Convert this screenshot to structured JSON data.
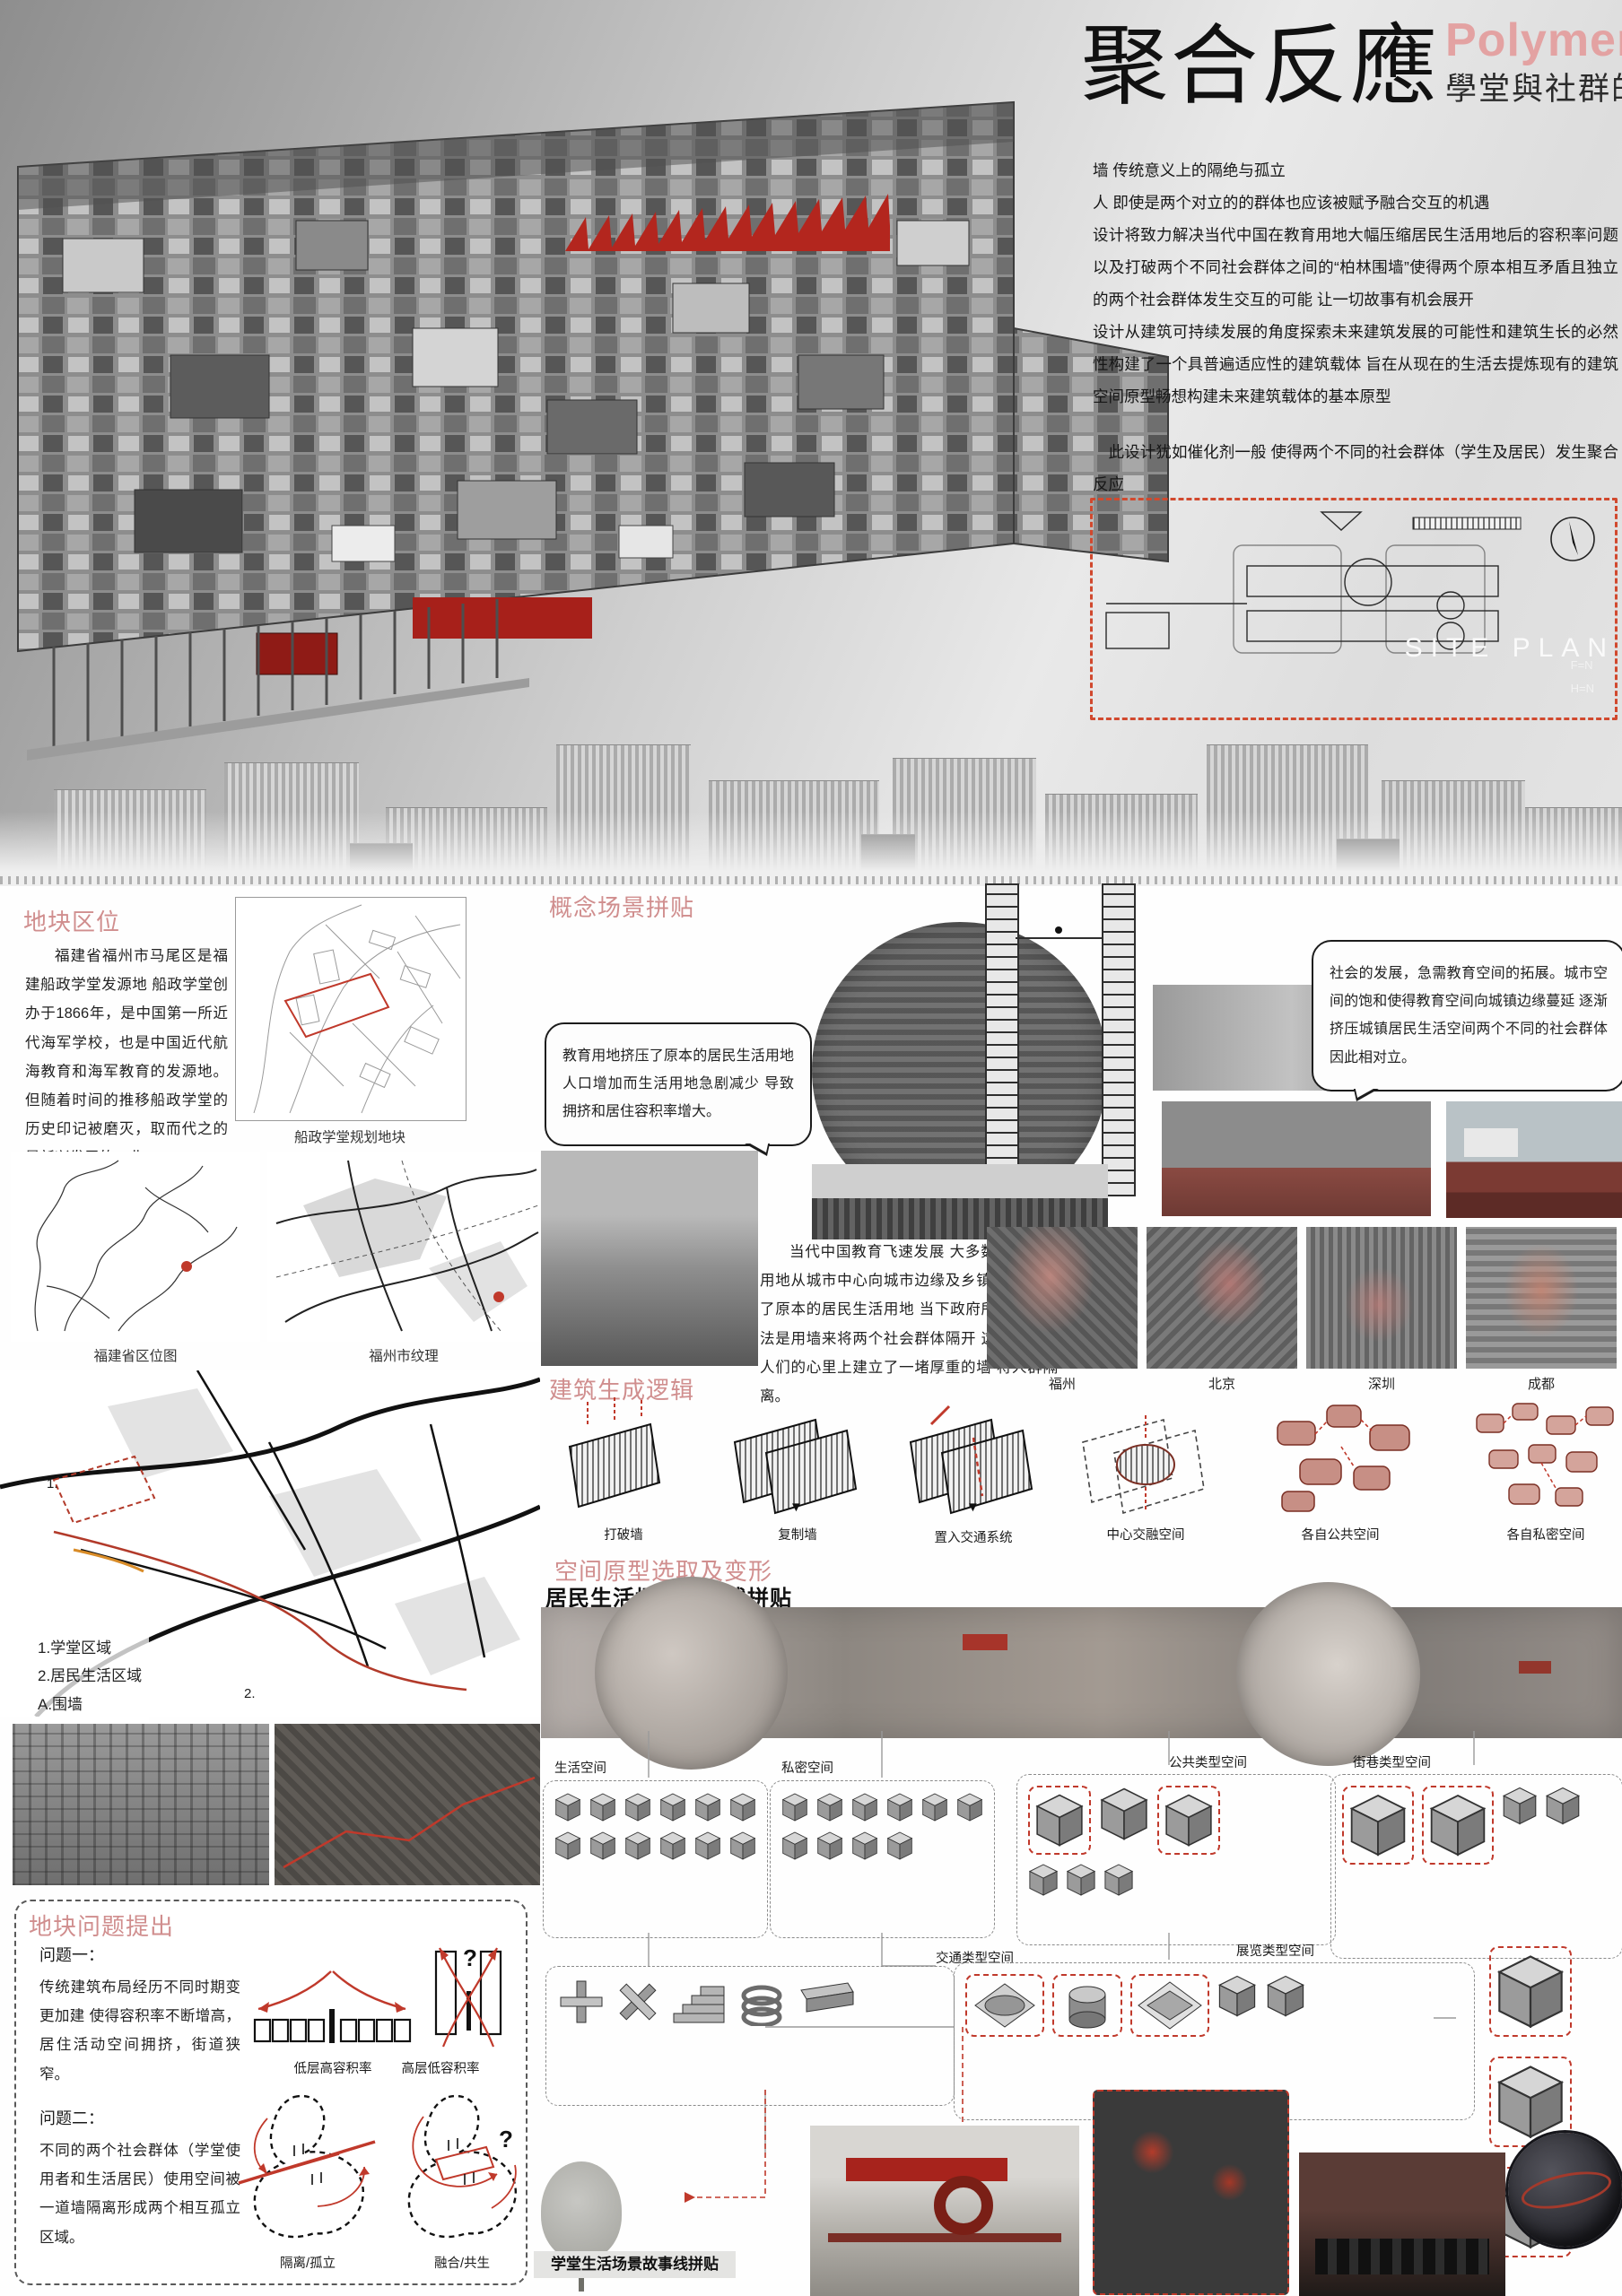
{
  "colors": {
    "heading_pink": "#d08e8e",
    "title_pink": "#e3a2a2",
    "accent_red": "#c0392b",
    "site_dash_red": "#d1492e"
  },
  "header": {
    "title_cn": "聚合反應",
    "title_en": "Polymerization",
    "subtitle": "學堂與社群的共生",
    "intro": [
      "墙 传统意义上的隔绝与孤立",
      "人 即使是两个对立的的群体也应该被赋予融合交互的机遇",
      "设计将致力解决当代中国在教育用地大幅压缩居民生活用地后的容积率问题以及打破两个不同社会群体之间的“柏林围墙”使得两个原本相互矛盾且独立的两个社会群体发生交互的可能 让一切故事有机会展开",
      "设计从建筑可持续发展的角度探索未来建筑发展的可能性和建筑生长的必然性构建了一个具普遍适应性的建筑载体 旨在从现在的生活去提炼现有的建筑空间原型畅想构建未来建筑载体的基本原型",
      "此设计犹如催化剂一般 使得两个不同的社会群体（学生及居民）发生聚合反应"
    ]
  },
  "site_plan": {
    "label": "SITE PLAN",
    "note1": "F=N",
    "note2": "H=N"
  },
  "location": {
    "heading": "地块区位",
    "p1": "福建省福州市马尾区是福建船政学堂发源地 船政学堂创办于1866年，是中国第一所近代海军学校，也是中国近代航海教育和海军教育的发源地。但随着时间的推移船政学堂的历史印记被磨灭，取而代之的是新兴发展的工业。",
    "p2": "如今中国教育发展叙述船政学堂得到复兴 新中国的教育发展迅速 教育用地扩张",
    "p3": "本设计讨论了中国教育建筑发展所面临的问题及未来教育建筑形式的趋势",
    "map_caption": "船政学堂规划地块",
    "cap_province": "福建省区位图",
    "cap_city": "福州市纹理"
  },
  "concept": {
    "heading": "概念场景拼贴",
    "bubble_left": "教育用地挤压了原本的居民生活用地 人口增加而生活用地急剧减少 导致拥挤和居住容积率增大。",
    "bubble_right": "社会的发展，急需教育空间的拓展。城市空间的饱和使得教育空间向城镇边缘蔓延 逐渐挤压城镇居民生活空间两个不同的社会群体因此相对立。",
    "paragraph": "当代中国教育飞速发展 大多数城市教育用地从城市中心向城市边缘及乡镇扩张 挤压了原本的居民生活用地 当下政府所采取的方法是用墙来将两个社会群体隔开 这同时也在人们的心里上建立了一堵厚重的墙 将人群隔离。",
    "cities": [
      "福州",
      "北京",
      "深圳",
      "成都"
    ]
  },
  "logic": {
    "heading": "建筑生成逻辑",
    "steps": [
      "打破墙",
      "复制墙",
      "置入交通系统",
      "中心交融空间",
      "各自公共空间",
      "各自私密空间"
    ]
  },
  "prototype": {
    "heading": "空间原型选取及变形",
    "subheading": "居民生活场景故事线拼贴"
  },
  "legend": {
    "item1": "1.学堂区域",
    "item2": "2.居民生活区域",
    "item3": "A.围墙",
    "item4": "B.居民建筑现状",
    "marker1": "1.",
    "marker2": "2."
  },
  "problems": {
    "heading": "地块问题提出",
    "q1_title": "问题一：",
    "q1_text": "传统建筑布局经历不同时期变更加建 使得容积率不断增高，居住活动空间拥挤，街道狭窄。",
    "q1_label_left": "低层高容积率",
    "q1_label_right": "高层低容积率",
    "q2_title": "问题二：",
    "q2_text": "不同的两个社会群体（学堂使用者和生活居民）使用空间被一道墙隔离形成两个相互孤立区域。",
    "q2_label_left": "隔离/孤立",
    "q2_label_right": "融合/共生",
    "question_mark": "?"
  },
  "typology": {
    "t1": "生活空间",
    "t2": "私密空间",
    "t3": "公共类型空间",
    "t4": "街巷类型空间",
    "t5": "交通类型空间",
    "t6": "展览类型空间"
  },
  "bottom": {
    "caption": "学堂生活场景故事线拼贴"
  },
  "icons": {
    "down_arrow": "▼"
  }
}
